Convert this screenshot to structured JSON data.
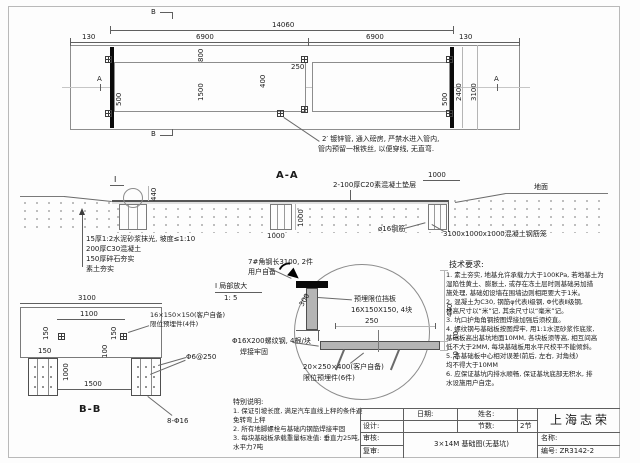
{
  "colors": {
    "paper": "#fdfdfd",
    "line_dark": "#5f5f5f",
    "line_light": "#b5b5b5",
    "steel_fill": "#b5b5b5",
    "thick_bar": "#0a0a0a"
  },
  "plan": {
    "marker_b_top": "B",
    "marker_b_bottom": "B",
    "marker_a_left": "A",
    "marker_a_right": "A",
    "dim_total": "14060",
    "dim_margin_left": "130",
    "dim_span_left": "6900",
    "dim_span_right": "6900",
    "dim_margin_right": "130",
    "dim_800": "800",
    "dim_1500": "1500",
    "dim_400": "400",
    "dim_250": "250",
    "dim_500_left": "500",
    "dim_500_right": "500",
    "dim_2400": "2400",
    "dim_3100": "3100",
    "pipe_note_line1": "2′ 镀锌管, 通入磅房, 严禁水进入管内,",
    "pipe_note_line2": "管内预留一根铁丝, 以便穿线, 无直弯."
  },
  "section_aa": {
    "title": "A-A",
    "detail_marker": "I",
    "dim_440": "440",
    "dim_pit_1000": "1000",
    "dim_pier_v_1000": "1000",
    "dim_pier_h_1000": "1000",
    "ground_label": "地面",
    "note_cushion": "2-100厚C20素混凝土垫层",
    "note_rebar": "ø16钢筋",
    "note_cage": "3100x1000x1000混凝土钢筋笼",
    "layers": [
      "15厚1:2水泥砂浆抹光, 坡度≤1:10",
      "200厚C30混凝土",
      "150厚碎石夯实",
      "素土夯实"
    ]
  },
  "section_bb": {
    "title": "B-B",
    "dim_3100": "3100",
    "dim_1100": "1100",
    "dim_150_left": "150",
    "dim_150_right": "150",
    "dim_150_h": "150",
    "dim_100": "100",
    "dim_1000": "1000",
    "dim_1500": "1500",
    "note_plate_line1": "16×150×150(客户自备)",
    "note_plate_line2": "限位预埋件(4件)",
    "note_stirrup": "Φ6@250",
    "note_rebar": "8-Φ16"
  },
  "detail_i": {
    "label": "I 局部放大",
    "scale": "1: 5",
    "dim_250": "250",
    "dim_300": "300",
    "dim_440": "440",
    "dim_10": "10",
    "dim_20": "20",
    "note_angle_line1": "7#角钢长3100, 2件",
    "note_angle_line2": "用户自备",
    "note_stop_line1": "预埋限位挡板",
    "note_stop_line2": "16X150X150, 4块",
    "note_bolt_line1": "Φ16X200螺纹钢, 4根/块",
    "note_bolt_line2": "焊接牢固",
    "note_plate_line1": "20×250×400(客户自备)",
    "note_plate_line2": "限位预埋件(6件)"
  },
  "special_notes": {
    "title": "特别说明:",
    "lines": [
      "1. 保证引坡长度, 满足汽车直线上秤的条件避",
      "免转弯上秤",
      "2. 所有地脚螺栓与基础内钢筋焊接牢固",
      "3. 每块基础板承载重量标准值: 垂直力25吨,",
      "水平力7吨"
    ]
  },
  "tech_notes": {
    "title": "技术要求:",
    "lines": [
      "1. 素土夯实, 地基允许承载力大于100KPa, 若地基土为",
      "湿陷性黄土、膨胀土, 或存在冻土层时则基础另加措",
      "施处理, 基础如设墙在围墙边则相距要大于1米。",
      "2. 混凝土为C30, 钢筋φ代表Ⅰ级钢, Φ代表Ⅱ级钢,",
      "标高尺寸以“米”记, 其余尺寸以“毫米”记。",
      "3. 坑口护角角钢按图焊接加强后须校直。",
      "4. 螺纹钢与基础板按图焊牢, 用1:1水泥砂浆作底浆,",
      "基础板高出基坑地面10MM, 各块板须等高, 相互间高",
      "低不大于2MM, 每块基础板用水平尺校平不能倾斜。",
      "5. 各基础板中心相对误差(前后, 左右, 对角线)",
      "均不得大于10MM",
      "6. 应保证基坑内排水顺畅, 保证基坑底部无积水, 排",
      "水设施用户自定。"
    ]
  },
  "title_block": {
    "date_label": "日期:",
    "name_label": "姓名:",
    "design_label": "设计:",
    "sections_label": "节数:",
    "sections_value": "2节",
    "check_label": "审核:",
    "recheck_label": "复审:",
    "drawing_title": "3×14M 基础图(无基坑)",
    "company": "上海志荣",
    "title_label": "名称:",
    "number_value": "编号: ZR3142-2"
  }
}
